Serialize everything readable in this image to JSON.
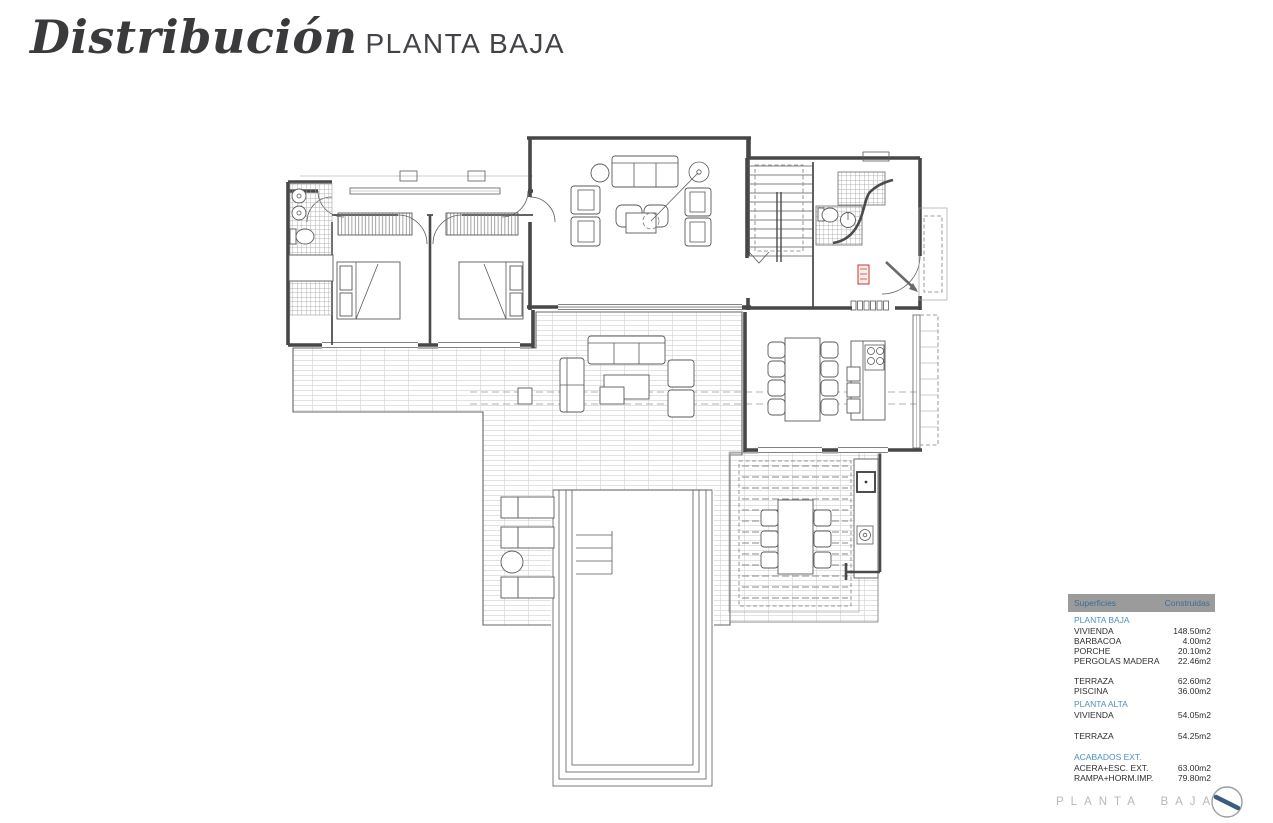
{
  "header": {
    "title_script": "Distribución",
    "title_caps": "PLANTA BAJA"
  },
  "areas_table": {
    "col_headers": [
      "Superficies",
      "Construidas"
    ],
    "groups": [
      {
        "header": "PLANTA BAJA",
        "rows": [
          {
            "label": "VIVIENDA",
            "value": "148.50m2"
          },
          {
            "label": "BARBACOA",
            "value": "4.00m2"
          },
          {
            "label": "PORCHE",
            "value": "20.10m2"
          },
          {
            "label": "PERGOLAS MADERA",
            "value": "22.46m2"
          }
        ]
      },
      {
        "rows": [
          {
            "label": "TERRAZA",
            "value": "62.60m2"
          },
          {
            "label": "PISCINA",
            "value": "36.00m2"
          }
        ]
      },
      {
        "header": "PLANTA ALTA",
        "rows": [
          {
            "label": "VIVIENDA",
            "value": "54.05m2"
          }
        ]
      },
      {
        "rows": [
          {
            "label": "TERRAZA",
            "value": "54.25m2"
          }
        ]
      },
      {
        "header": "ACABADOS EXT.",
        "rows": [
          {
            "label": "ACERA+ESC. EXT.",
            "value": "63.00m2"
          },
          {
            "label": "RAMPA+HORM.IMP.",
            "value": "79.80m2"
          }
        ]
      }
    ]
  },
  "footer": {
    "label": "PLANTA BAJA"
  },
  "colors": {
    "wall": "#474747",
    "tile_line": "#c6c6c6",
    "accent_red": "#c0392b",
    "table_header_bg": "#9b9b9b",
    "table_header_text": "#3d6c94",
    "section_text": "#4e8fc0",
    "footer_text": "#b5b8bb",
    "compass_needle": "#3d5c7d"
  }
}
